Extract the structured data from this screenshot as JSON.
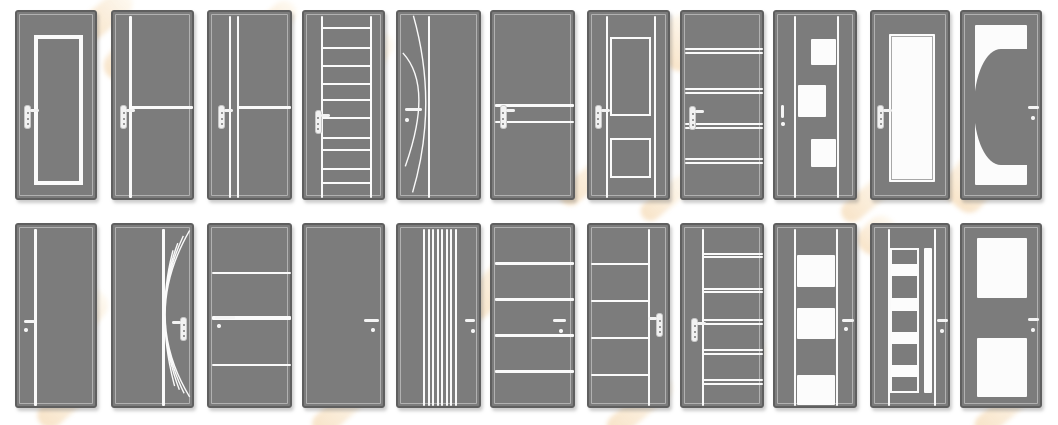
{
  "catalog": {
    "description": "grid of interior door design thumbnails, gray doors with white inlay patterns",
    "rows": 2,
    "columns": 11
  },
  "colors": {
    "background": "#ffffff",
    "door_fill": "#7c7c7c",
    "door_border": "#5f5f5f",
    "inner_outline": "#c8c8c8",
    "detail_white": "#fafafa",
    "watermark_orange": "#e7a348"
  },
  "layout": {
    "col_lefts": [
      15,
      111,
      207,
      302,
      396,
      490,
      587,
      680,
      773,
      870,
      960
    ],
    "col_widths": [
      82,
      83,
      85,
      83,
      85,
      85,
      83,
      84,
      84,
      80,
      82
    ],
    "row_tops": [
      10,
      223
    ],
    "row_heights": [
      190,
      185
    ]
  },
  "doors": [
    {
      "row": 0,
      "col": 0,
      "name": "framed-inset-panel",
      "features": [
        {
          "t": "outline",
          "x": 0.21,
          "y": 0.12,
          "w": 0.6,
          "h": 0.79,
          "bw": 4
        }
      ],
      "handle": {
        "type": "plate",
        "cx": 0.13,
        "cy": 0.55,
        "dir": "right"
      }
    },
    {
      "row": 0,
      "col": 1,
      "name": "vline-with-mid-hline",
      "features": [
        {
          "t": "vline",
          "x": 0.21,
          "w": 3
        },
        {
          "t": "hline",
          "y": 0.5,
          "x1": 0.21,
          "x2": 0.965,
          "h": 3
        }
      ],
      "handle": {
        "type": "plate",
        "cx": 0.13,
        "cy": 0.55,
        "dir": "right"
      }
    },
    {
      "row": 0,
      "col": 2,
      "name": "double-vline-with-mid-hline",
      "features": [
        {
          "t": "vline",
          "x": 0.25,
          "w": 2
        },
        {
          "t": "vline",
          "x": 0.345,
          "w": 2
        },
        {
          "t": "hline",
          "y": 0.5,
          "x1": 0.345,
          "x2": 0.965,
          "h": 3
        }
      ],
      "handle": {
        "type": "plate",
        "cx": 0.15,
        "cy": 0.55,
        "dir": "right"
      }
    },
    {
      "row": 0,
      "col": 3,
      "name": "ladder",
      "features": [
        {
          "t": "vline",
          "x": 0.22,
          "w": 2
        },
        {
          "t": "vline",
          "x": 0.81,
          "w": 2
        },
        {
          "t": "hline",
          "y": 0.086,
          "x1": 0.22,
          "x2": 0.81
        },
        {
          "t": "hline",
          "y": 0.188,
          "x1": 0.22,
          "x2": 0.81
        },
        {
          "t": "hline",
          "y": 0.284,
          "x1": 0.22,
          "x2": 0.81
        },
        {
          "t": "hline",
          "y": 0.379,
          "x1": 0.22,
          "x2": 0.81
        },
        {
          "t": "hline",
          "y": 0.463,
          "x1": 0.22,
          "x2": 0.81
        },
        {
          "t": "hline",
          "y": 0.559,
          "x1": 0.22,
          "x2": 0.81
        },
        {
          "t": "hline",
          "y": 0.665,
          "x1": 0.22,
          "x2": 0.81
        },
        {
          "t": "hline",
          "y": 0.726,
          "x1": 0.22,
          "x2": 0.81
        },
        {
          "t": "hline",
          "y": 0.828,
          "x1": 0.22,
          "x2": 0.81
        },
        {
          "t": "hline",
          "y": 0.898,
          "x1": 0.22,
          "x2": 0.81
        }
      ],
      "handle": {
        "type": "plate",
        "cx": 0.17,
        "cy": 0.58,
        "dir": "right"
      }
    },
    {
      "row": 0,
      "col": 4,
      "name": "arc-curves",
      "features": [
        {
          "t": "vline",
          "x": 0.37,
          "w": 2
        },
        {
          "t": "curve",
          "d": "M19,2 Q50,50 18,97"
        },
        {
          "t": "curve",
          "d": "M6,22 Q44,40 9,83"
        }
      ],
      "handle": {
        "type": "lever",
        "x1": 0.08,
        "x2": 0.28,
        "cy": 0.515,
        "dotx": 0.105,
        "doty": 0.57
      }
    },
    {
      "row": 0,
      "col": 5,
      "name": "double-mid-hline",
      "features": [
        {
          "t": "hline",
          "y": 0.49,
          "h": 3
        },
        {
          "t": "hline",
          "y": 0.578,
          "h": 2
        }
      ],
      "handle": {
        "type": "plate",
        "cx": 0.13,
        "cy": 0.55,
        "dir": "right"
      }
    },
    {
      "row": 0,
      "col": 6,
      "name": "two-framed-panels",
      "features": [
        {
          "t": "vline",
          "x": 0.22,
          "w": 2
        },
        {
          "t": "vline",
          "x": 0.79,
          "w": 2
        },
        {
          "t": "outline",
          "x": 0.25,
          "y": 0.13,
          "w": 0.5,
          "h": 0.42,
          "bw": 2
        },
        {
          "t": "outline",
          "x": 0.25,
          "y": 0.665,
          "w": 0.5,
          "h": 0.21,
          "bw": 2
        }
      ],
      "handle": {
        "type": "plate",
        "cx": 0.11,
        "cy": 0.55,
        "dir": "right"
      }
    },
    {
      "row": 0,
      "col": 7,
      "name": "four-double-hlines",
      "features": [
        {
          "t": "hline",
          "y": 0.193
        },
        {
          "t": "hline",
          "y": 0.216
        },
        {
          "t": "hline",
          "y": 0.403
        },
        {
          "t": "hline",
          "y": 0.426
        },
        {
          "t": "hline",
          "y": 0.587
        },
        {
          "t": "hline",
          "y": 0.61
        },
        {
          "t": "hline",
          "y": 0.772
        },
        {
          "t": "hline",
          "y": 0.795
        }
      ],
      "handle": {
        "type": "plate",
        "cx": 0.13,
        "cy": 0.557,
        "dir": "right"
      }
    },
    {
      "row": 0,
      "col": 8,
      "name": "checkered-squares",
      "features": [
        {
          "t": "vline",
          "x": 0.242,
          "w": 2
        },
        {
          "t": "vline",
          "x": 0.75,
          "w": 2
        },
        {
          "t": "panel",
          "x": 0.432,
          "y": 0.14,
          "w": 0.3,
          "h": 0.14
        },
        {
          "t": "panel",
          "x": 0.274,
          "y": 0.386,
          "w": 0.336,
          "h": 0.167
        },
        {
          "t": "panel",
          "x": 0.432,
          "y": 0.667,
          "w": 0.3,
          "h": 0.15
        }
      ],
      "handle": {
        "type": "vlever",
        "cx": 0.095,
        "y1": 0.488,
        "y2": 0.558,
        "doty": 0.59
      }
    },
    {
      "row": 0,
      "col": 9,
      "name": "full-glass",
      "features": [
        {
          "t": "panel",
          "x": 0.21,
          "y": 0.114,
          "w": 0.58,
          "h": 0.78,
          "inner": true
        }
      ],
      "handle": {
        "type": "plate",
        "cx": 0.11,
        "cy": 0.553,
        "dir": "right"
      }
    },
    {
      "row": 0,
      "col": 10,
      "name": "half-circle-glass",
      "features": [
        {
          "t": "panel",
          "x": 0.16,
          "y": 0.07,
          "w": 0.63,
          "h": 0.84
        },
        {
          "t": "halfdisc",
          "x": 0.15,
          "y": 0.195,
          "w": 0.655,
          "h": 0.61
        }
      ],
      "handle": {
        "type": "lever",
        "x1": 0.81,
        "x2": 0.935,
        "cy": 0.5,
        "dotx": 0.87,
        "doty": 0.56
      }
    },
    {
      "row": 1,
      "col": 0,
      "name": "single-vline",
      "features": [
        {
          "t": "vline",
          "x": 0.23,
          "w": 3
        }
      ],
      "handle": {
        "type": "lever",
        "x1": 0.09,
        "x2": 0.225,
        "cy": 0.52,
        "dotx": 0.105,
        "doty": 0.57
      }
    },
    {
      "row": 1,
      "col": 1,
      "name": "fan-curves",
      "features": [
        {
          "t": "vline",
          "x": 0.61,
          "w": 3
        },
        {
          "t": "curve",
          "d": "M97,3 Q35,50 97,95"
        },
        {
          "t": "curve",
          "d": "M89,6 Q42,50 90,93"
        },
        {
          "t": "curve",
          "d": "M82,10 Q48,50 84,91"
        },
        {
          "t": "curve",
          "d": "M76,14 Q54,50 78,89"
        }
      ],
      "handle": {
        "type": "plate",
        "cx": 0.85,
        "cy": 0.56,
        "dir": "left"
      }
    },
    {
      "row": 1,
      "col": 2,
      "name": "three-hlines",
      "features": [
        {
          "t": "hline",
          "y": 0.26,
          "h": 2
        },
        {
          "t": "hline",
          "y": 0.5,
          "h": 4
        },
        {
          "t": "hline",
          "y": 0.755,
          "h": 2
        }
      ],
      "handle": {
        "type": "lever",
        "x1": 0.075,
        "x2": 0.3,
        "cy": 0.5,
        "dotx": 0.114,
        "doty": 0.545
      }
    },
    {
      "row": 1,
      "col": 3,
      "name": "plain",
      "features": [],
      "handle": {
        "type": "lever",
        "x1": 0.72,
        "x2": 0.9,
        "cy": 0.515,
        "dotx": 0.826,
        "doty": 0.565
      }
    },
    {
      "row": 1,
      "col": 4,
      "name": "vertical-stripes",
      "features": [
        {
          "t": "vline",
          "x": 0.305,
          "w": 2
        },
        {
          "t": "vline",
          "x": 0.359,
          "w": 2
        },
        {
          "t": "vline",
          "x": 0.413,
          "w": 2
        },
        {
          "t": "vline",
          "x": 0.467,
          "w": 2
        },
        {
          "t": "vline",
          "x": 0.521,
          "w": 2
        },
        {
          "t": "vline",
          "x": 0.575,
          "w": 2
        },
        {
          "t": "vline",
          "x": 0.629,
          "w": 2
        },
        {
          "t": "vline",
          "x": 0.683,
          "w": 2
        }
      ],
      "handle": {
        "type": "lever",
        "x1": 0.787,
        "x2": 0.906,
        "cy": 0.515,
        "dotx": 0.88,
        "doty": 0.571
      }
    },
    {
      "row": 1,
      "col": 5,
      "name": "four-hlines",
      "features": [
        {
          "t": "hline",
          "y": 0.207,
          "h": 3
        },
        {
          "t": "hline",
          "y": 0.405,
          "h": 3
        },
        {
          "t": "hline",
          "y": 0.595,
          "h": 3
        },
        {
          "t": "hline",
          "y": 0.793,
          "h": 3
        }
      ],
      "handle": {
        "type": "lever",
        "x1": 0.714,
        "x2": 0.87,
        "cy": 0.515,
        "dotx": 0.808,
        "doty": 0.571
      }
    },
    {
      "row": 1,
      "col": 6,
      "name": "right-vline-four-hlines",
      "features": [
        {
          "t": "vline",
          "x": 0.72,
          "w": 2
        },
        {
          "t": "hline",
          "y": 0.213,
          "x1": 0.03,
          "x2": 0.72
        },
        {
          "t": "hline",
          "y": 0.411,
          "x1": 0.03,
          "x2": 0.72
        },
        {
          "t": "hline",
          "y": 0.609,
          "x1": 0.03,
          "x2": 0.72
        },
        {
          "t": "hline",
          "y": 0.811,
          "x1": 0.03,
          "x2": 0.72
        }
      ],
      "handle": {
        "type": "plate",
        "cx": 0.85,
        "cy": 0.54,
        "dir": "left"
      }
    },
    {
      "row": 1,
      "col": 7,
      "name": "left-vline-five-double-hlines",
      "features": [
        {
          "t": "vline",
          "x": 0.25,
          "w": 2
        },
        {
          "t": "hline",
          "y": 0.155,
          "x1": 0.25,
          "x2": 0.965
        },
        {
          "t": "hline",
          "y": 0.173,
          "x1": 0.25,
          "x2": 0.965
        },
        {
          "t": "hline",
          "y": 0.344,
          "x1": 0.25,
          "x2": 0.965
        },
        {
          "t": "hline",
          "y": 0.362,
          "x1": 0.25,
          "x2": 0.965
        },
        {
          "t": "hline",
          "y": 0.515,
          "x1": 0.25,
          "x2": 0.965
        },
        {
          "t": "hline",
          "y": 0.533,
          "x1": 0.25,
          "x2": 0.965
        },
        {
          "t": "hline",
          "y": 0.677,
          "x1": 0.25,
          "x2": 0.965
        },
        {
          "t": "hline",
          "y": 0.695,
          "x1": 0.25,
          "x2": 0.965
        },
        {
          "t": "hline",
          "y": 0.84,
          "x1": 0.25,
          "x2": 0.965
        },
        {
          "t": "hline",
          "y": 0.858,
          "x1": 0.25,
          "x2": 0.965
        }
      ],
      "handle": {
        "type": "plate",
        "cx": 0.15,
        "cy": 0.565,
        "dir": "right"
      }
    },
    {
      "row": 1,
      "col": 8,
      "name": "center-glass-column",
      "features": [
        {
          "t": "vline",
          "x": 0.24,
          "w": 2
        },
        {
          "t": "vline",
          "x": 0.738,
          "w": 2
        },
        {
          "t": "panel",
          "x": 0.26,
          "y": 0.164,
          "w": 0.46,
          "h": 0.171
        },
        {
          "t": "panel",
          "x": 0.26,
          "y": 0.449,
          "w": 0.46,
          "h": 0.166
        },
        {
          "t": "panel",
          "x": 0.26,
          "y": 0.812,
          "w": 0.46,
          "h": 0.161
        }
      ],
      "handle": {
        "type": "lever",
        "x1": 0.8,
        "x2": 0.937,
        "cy": 0.515,
        "dotx": 0.845,
        "doty": 0.562
      }
    },
    {
      "row": 1,
      "col": 9,
      "name": "ladder-column-with-strip",
      "features": [
        {
          "t": "vline",
          "x": 0.21,
          "w": 2
        },
        {
          "t": "vline",
          "x": 0.785,
          "w": 2
        },
        {
          "t": "outline",
          "x": 0.225,
          "y": 0.125,
          "w": 0.365,
          "h": 0.785,
          "bw": 2
        },
        {
          "t": "panel",
          "x": 0.655,
          "y": 0.126,
          "w": 0.1,
          "h": 0.784
        },
        {
          "t": "panel",
          "x": 0.235,
          "y": 0.212,
          "w": 0.345,
          "h": 0.064
        },
        {
          "t": "panel",
          "x": 0.235,
          "y": 0.396,
          "w": 0.345,
          "h": 0.067
        },
        {
          "t": "panel",
          "x": 0.235,
          "y": 0.577,
          "w": 0.345,
          "h": 0.066
        },
        {
          "t": "panel",
          "x": 0.235,
          "y": 0.757,
          "w": 0.345,
          "h": 0.066
        }
      ],
      "handle": {
        "type": "lever",
        "x1": 0.807,
        "x2": 0.952,
        "cy": 0.518,
        "dotx": 0.88,
        "doty": 0.573
      }
    },
    {
      "row": 1,
      "col": 10,
      "name": "two-glass-panels",
      "features": [
        {
          "t": "panel",
          "x": 0.18,
          "y": 0.072,
          "w": 0.61,
          "h": 0.324
        },
        {
          "t": "panel",
          "x": 0.18,
          "y": 0.613,
          "w": 0.61,
          "h": 0.315
        }
      ],
      "handle": {
        "type": "lever",
        "x1": 0.8,
        "x2": 0.94,
        "cy": 0.513,
        "dotx": 0.868,
        "doty": 0.57
      }
    }
  ],
  "watermarks": [
    {
      "x": 75,
      "y": 2,
      "w": 62,
      "h": 26,
      "r": -40
    },
    {
      "x": 103,
      "y": 38,
      "w": 56,
      "h": 40,
      "r": -52
    },
    {
      "x": 248,
      "y": 10,
      "w": 52,
      "h": 24,
      "r": -42
    },
    {
      "x": 330,
      "y": 42,
      "w": 56,
      "h": 44,
      "r": -55
    },
    {
      "x": 305,
      "y": 60,
      "w": 100,
      "h": 24,
      "r": -45
    },
    {
      "x": 655,
      "y": 20,
      "w": 50,
      "h": 46,
      "r": -50
    },
    {
      "x": 878,
      "y": 90,
      "w": 38,
      "h": 30,
      "r": -45
    },
    {
      "x": 554,
      "y": 168,
      "w": 70,
      "h": 22,
      "r": -40
    },
    {
      "x": 636,
      "y": 188,
      "w": 60,
      "h": 20,
      "r": -40
    },
    {
      "x": 836,
      "y": 186,
      "w": 66,
      "h": 22,
      "r": -40
    },
    {
      "x": 944,
      "y": 160,
      "w": 54,
      "h": 46,
      "r": -50
    },
    {
      "x": 52,
      "y": 290,
      "w": 56,
      "h": 42,
      "r": -50
    },
    {
      "x": 120,
      "y": 240,
      "w": 70,
      "h": 24,
      "r": -42
    },
    {
      "x": 32,
      "y": 388,
      "w": 68,
      "h": 26,
      "r": -42
    },
    {
      "x": 306,
      "y": 396,
      "w": 72,
      "h": 24,
      "r": -42
    },
    {
      "x": 452,
      "y": 268,
      "w": 88,
      "h": 30,
      "r": -48
    },
    {
      "x": 600,
      "y": 396,
      "w": 80,
      "h": 22,
      "r": -40
    },
    {
      "x": 696,
      "y": 352,
      "w": 76,
      "h": 30,
      "r": -45
    },
    {
      "x": 856,
      "y": 220,
      "w": 42,
      "h": 30,
      "r": -45
    },
    {
      "x": 968,
      "y": 396,
      "w": 78,
      "h": 22,
      "r": -40
    }
  ]
}
